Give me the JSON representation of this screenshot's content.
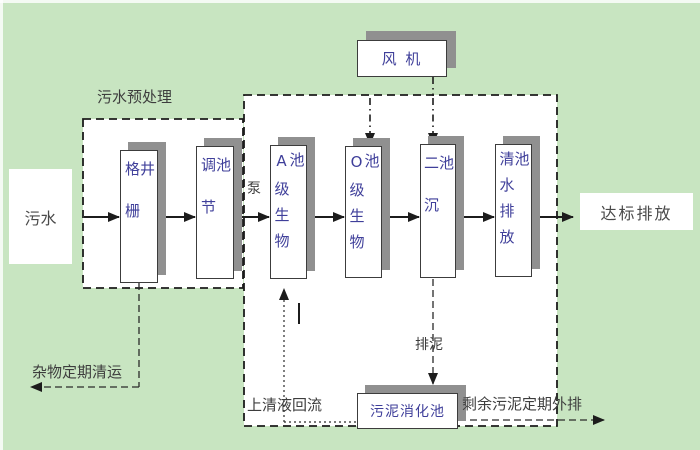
{
  "diagram": {
    "type": "process-flow-diagram",
    "subject": "wastewater treatment plant flow",
    "background_color": "#c8e5c1",
    "panel_color": "#ffffff",
    "pool_text_color": "#3f3f9a",
    "label_text_color": "#3d3d3d",
    "shadow_color": "#909090",
    "line_color": "#1c1c1c"
  },
  "groups": {
    "pretreatment_label": "污水预处理"
  },
  "nodes": {
    "influent": "污水",
    "grid_well": "格栅井",
    "regulating_tank": "调节池",
    "a_bio_tank": "A级生物池",
    "o_bio_tank": "O级生物池",
    "secondary_clarifier": "二沉池",
    "clear_water_tank": "清水排放池",
    "blower": "风 机",
    "sludge_digester": "污泥消化池",
    "discharge": "达标排放"
  },
  "edge_labels": {
    "pump": "泵",
    "debris_removal": "杂物定期清运",
    "supernatant_reflux": "上清液回流",
    "sludge_discharge": "排泥",
    "excess_sludge_out": "剩余污泥定期外排"
  }
}
